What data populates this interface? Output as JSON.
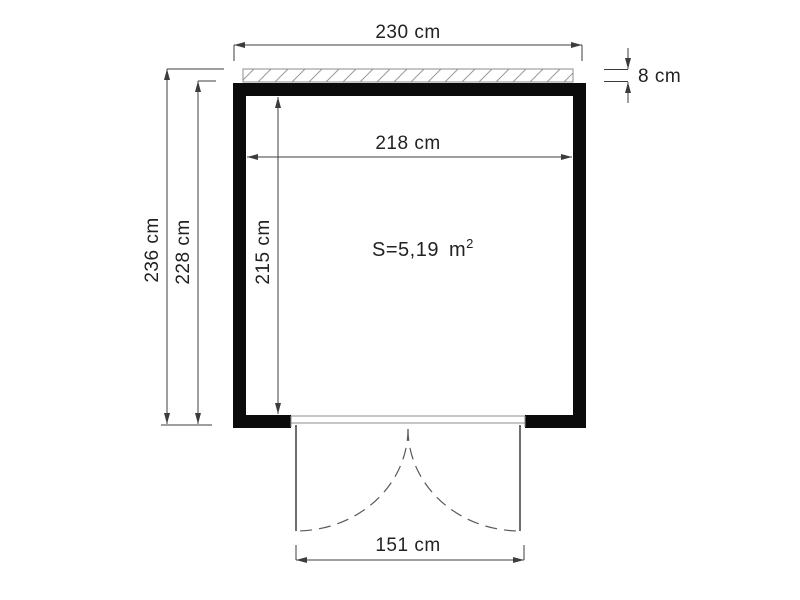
{
  "plan": {
    "dims": {
      "outer_width": "230 cm",
      "roof_overhang": "8 cm",
      "inner_width": "218 cm",
      "outer_depth": "236 cm",
      "wall_depth": "228 cm",
      "inner_depth": "215 cm",
      "door_width": "151 cm"
    },
    "area": {
      "prefix": "S=5,19",
      "unit": "m",
      "exponent": "2"
    },
    "colors": {
      "wall": "#0b0b0b",
      "line": "#3c3c3c",
      "text": "#222222",
      "frame": "#8c8c8c",
      "swing": "#5a5a5a"
    }
  }
}
